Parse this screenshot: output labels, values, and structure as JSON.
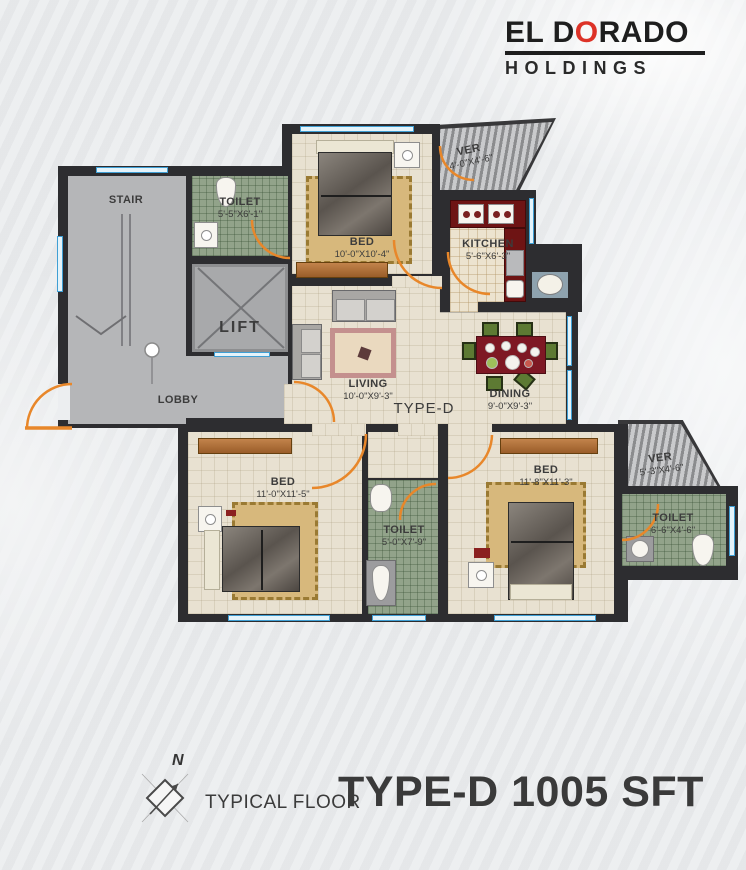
{
  "logo": {
    "part1": "EL D",
    "accent_letter": "O",
    "part2": "RADO",
    "subtitle": "HOLDINGS"
  },
  "rooms": {
    "stair": {
      "label": "STAIR"
    },
    "toilet_top": {
      "label": "TOILET",
      "dim": "5'-5\"X6'-1\""
    },
    "lift": {
      "label": "LIFT"
    },
    "lobby": {
      "label": "LOBBY"
    },
    "bed_top": {
      "label": "BED",
      "dim": "10'-0\"X10'-4\""
    },
    "ver_top": {
      "label": "VER",
      "dim": "4'-0\"X4'-6\""
    },
    "kitchen": {
      "label": "KITCHEN",
      "dim": "5'-6\"X6'-3\""
    },
    "living": {
      "label": "LIVING",
      "dim": "10'-0\"X9'-3\""
    },
    "dining": {
      "label": "DINING",
      "dim": "9'-0\"X9'-3\""
    },
    "bed_left": {
      "label": "BED",
      "dim": "11'-0\"X11'-5\""
    },
    "toilet_mid": {
      "label": "TOILET",
      "dim": "5'-0\"X7'-9\""
    },
    "bed_right": {
      "label": "BED",
      "dim": "11'-8\"X11'-3\""
    },
    "ver_right": {
      "label": "VER",
      "dim": "5'-3\"X4'-6\""
    },
    "toilet_right": {
      "label": "TOILET",
      "dim": "6'-6\"X4'-6\""
    }
  },
  "plan": {
    "type_label": "TYPE-D"
  },
  "footer": {
    "compass_letter": "N",
    "caption": "TYPICAL FLOOR",
    "title": "TYPE-D 1005 SFT"
  },
  "colors": {
    "wall": "#2d2d30",
    "door": "#e8872a",
    "window_line": "#3f9fd4",
    "logo_red": "#dd3227",
    "counter_red": "#6e1414",
    "dining_table_red": "#7e1824",
    "chair_green": "#5d7a33",
    "toilet_tile_green": "#92a38a",
    "floor_cream": "#e8e1d1",
    "floor_gray": "#b5b6b8"
  }
}
